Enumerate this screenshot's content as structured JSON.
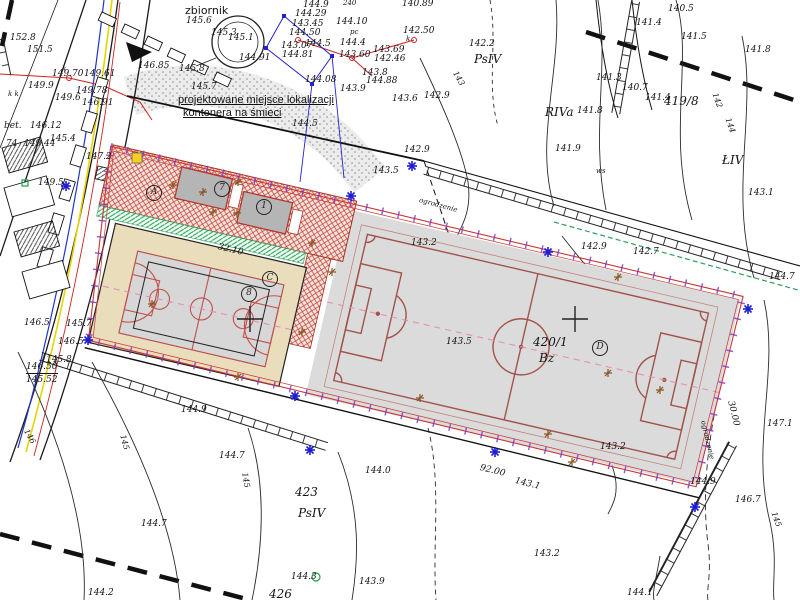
{
  "map": {
    "note_line1": "projektowane miejsce lokalizacji",
    "note_line2": "kontenera na śmieci",
    "parcels_visible": [
      "419/8",
      "420/1",
      "423",
      "426"
    ],
    "land_use_codes": [
      "PsIV",
      "RIVa",
      "ŁIV",
      "Bz",
      "ws"
    ],
    "colors": {
      "fence_red": "#cc3333",
      "tick_purple": "#7d3cc0",
      "hatch_red": "#c0392b",
      "pitch_line_red": "#a2524a",
      "axis_pink": "#e78fb3",
      "green_strip": "#27a35a",
      "field_gray": "#dbdbdb",
      "court_beige": "#e9ddbc",
      "survey_blue": "#1d1dd8",
      "utility_blue": "#2233cc",
      "utility_yellow": "#e8d400",
      "utility_red": "#cc2222",
      "marker_brown": "#8a5420",
      "building_black": "#111111"
    },
    "labels": [
      {
        "t": "152.8",
        "x": 10,
        "y": 34
      },
      {
        "t": "151.5",
        "x": 27,
        "y": 46
      },
      {
        "t": "149.70",
        "x": 52,
        "y": 70
      },
      {
        "t": "149.9",
        "x": 28,
        "y": 82
      },
      {
        "t": "k",
        "x": 62,
        "y": 66,
        "k": "t"
      },
      {
        "t": "k k",
        "x": 8,
        "y": 91,
        "k": "t"
      },
      {
        "t": "149.61",
        "x": 84,
        "y": 70
      },
      {
        "t": "149.78",
        "x": 76,
        "y": 87
      },
      {
        "t": "149.6",
        "x": 55,
        "y": 94
      },
      {
        "t": "146.91",
        "x": 82,
        "y": 99
      },
      {
        "t": "bet.",
        "x": 4,
        "y": 122
      },
      {
        "t": "146.12",
        "x": 30,
        "y": 122
      },
      {
        "t": "74",
        "x": 6,
        "y": 140
      },
      {
        "t": "149.44",
        "x": 24,
        "y": 140
      },
      {
        "t": "145.4",
        "x": 50,
        "y": 135
      },
      {
        "t": "147.2",
        "x": 86,
        "y": 153
      },
      {
        "t": "149.5",
        "x": 38,
        "y": 179
      },
      {
        "t": "146.5",
        "x": 24,
        "y": 319
      },
      {
        "t": "145.7",
        "x": 66,
        "y": 320
      },
      {
        "t": "146.5",
        "x": 58,
        "y": 338
      },
      {
        "t": "145.8",
        "x": 46,
        "y": 356
      },
      {
        "t": "146.50",
        "x": 26,
        "y": 363,
        "k": "fr"
      },
      {
        "t": "145.52",
        "x": 26,
        "y": 376
      },
      {
        "t": "144.9",
        "x": 181,
        "y": 406
      },
      {
        "t": "zbiornik",
        "x": 185,
        "y": 5,
        "k": "n2"
      },
      {
        "t": "145.6",
        "x": 186,
        "y": 17
      },
      {
        "t": "145.1",
        "x": 228,
        "y": 34
      },
      {
        "t": "145.3",
        "x": 211,
        "y": 29
      },
      {
        "t": "144.91",
        "x": 239,
        "y": 54
      },
      {
        "t": "145.8",
        "x": 179,
        "y": 65
      },
      {
        "t": "145.7",
        "x": 191,
        "y": 83
      },
      {
        "t": "146.85",
        "x": 138,
        "y": 62
      },
      {
        "t": "144.9",
        "x": 303,
        "y": 1
      },
      {
        "t": "144.29",
        "x": 295,
        "y": 10
      },
      {
        "t": "143.45",
        "x": 292,
        "y": 20
      },
      {
        "t": "144.50",
        "x": 289,
        "y": 29
      },
      {
        "t": "143.07",
        "x": 281,
        "y": 42
      },
      {
        "t": "144.5",
        "x": 305,
        "y": 40
      },
      {
        "t": "144.81",
        "x": 282,
        "y": 51
      },
      {
        "t": "144.10",
        "x": 336,
        "y": 18
      },
      {
        "t": "144.4",
        "x": 340,
        "y": 39
      },
      {
        "t": "143.69",
        "x": 373,
        "y": 46
      },
      {
        "t": "143.60",
        "x": 339,
        "y": 51
      },
      {
        "t": "142.46",
        "x": 374,
        "y": 55
      },
      {
        "t": "142.50",
        "x": 403,
        "y": 27
      },
      {
        "t": "143.8",
        "x": 362,
        "y": 69
      },
      {
        "t": "144.08",
        "x": 305,
        "y": 76
      },
      {
        "t": "144.88",
        "x": 366,
        "y": 77
      },
      {
        "t": "143.9",
        "x": 340,
        "y": 85
      },
      {
        "t": "240",
        "x": 343,
        "y": 0,
        "k": "t"
      },
      {
        "t": "pc",
        "x": 350,
        "y": 29,
        "k": "t"
      },
      {
        "t": "k",
        "x": 406,
        "y": 36,
        "k": "t"
      },
      {
        "t": "140.89",
        "x": 402,
        "y": 0
      },
      {
        "t": "144.5",
        "x": 292,
        "y": 120
      },
      {
        "t": "143.6",
        "x": 392,
        "y": 95
      },
      {
        "t": "142.9",
        "x": 424,
        "y": 92
      },
      {
        "t": "142.2",
        "x": 469,
        "y": 40
      },
      {
        "t": "PsIV",
        "x": 474,
        "y": 53,
        "k": "lu"
      },
      {
        "t": "142.9",
        "x": 404,
        "y": 146
      },
      {
        "t": "143.5",
        "x": 373,
        "y": 167
      },
      {
        "t": "141.4",
        "x": 636,
        "y": 19
      },
      {
        "t": "140.5",
        "x": 668,
        "y": 5
      },
      {
        "t": "141.5",
        "x": 681,
        "y": 33
      },
      {
        "t": "141.8",
        "x": 745,
        "y": 46
      },
      {
        "t": "141.3",
        "x": 596,
        "y": 74
      },
      {
        "t": "140.7",
        "x": 622,
        "y": 84
      },
      {
        "t": "141.4",
        "x": 645,
        "y": 94
      },
      {
        "t": "419/8",
        "x": 664,
        "y": 95,
        "k": "p"
      },
      {
        "t": "RIVa",
        "x": 545,
        "y": 106,
        "k": "lu"
      },
      {
        "t": "141.8",
        "x": 577,
        "y": 107
      },
      {
        "t": "141.9",
        "x": 555,
        "y": 145
      },
      {
        "t": "ŁIV",
        "x": 722,
        "y": 154,
        "k": "lu"
      },
      {
        "t": "143.1",
        "x": 748,
        "y": 189
      },
      {
        "t": "ws",
        "x": 596,
        "y": 168,
        "k": "t"
      },
      {
        "t": "142",
        "x": 718,
        "y": 92,
        "k": "c",
        "r": 70
      },
      {
        "t": "144",
        "x": 731,
        "y": 117,
        "k": "c",
        "r": 70
      },
      {
        "t": "143",
        "x": 458,
        "y": 70,
        "k": "c",
        "r": 60
      },
      {
        "t": "143.2",
        "x": 411,
        "y": 239
      },
      {
        "t": "143.5",
        "x": 446,
        "y": 338
      },
      {
        "t": "420/1",
        "x": 533,
        "y": 336,
        "k": "p"
      },
      {
        "t": "Bz",
        "x": 539,
        "y": 352,
        "k": "p"
      },
      {
        "t": "142.9",
        "x": 581,
        "y": 243
      },
      {
        "t": "142.7",
        "x": 633,
        "y": 248
      },
      {
        "t": "144.7",
        "x": 769,
        "y": 273
      },
      {
        "t": "143.2",
        "x": 600,
        "y": 443
      },
      {
        "t": "144.9",
        "x": 690,
        "y": 478
      },
      {
        "t": "146.7",
        "x": 735,
        "y": 496
      },
      {
        "t": "147.1",
        "x": 767,
        "y": 420
      },
      {
        "t": "143.2",
        "x": 534,
        "y": 550
      },
      {
        "t": "144.1",
        "x": 627,
        "y": 589
      },
      {
        "t": "145",
        "x": 777,
        "y": 511,
        "k": "c",
        "r": 70
      },
      {
        "t": "30.00",
        "x": 734,
        "y": 400,
        "k": "d",
        "r": 76
      },
      {
        "t": "144.0",
        "x": 365,
        "y": 467
      },
      {
        "t": "423",
        "x": 295,
        "y": 486,
        "k": "p"
      },
      {
        "t": "PsIV",
        "x": 298,
        "y": 507,
        "k": "lu"
      },
      {
        "t": "144.3",
        "x": 291,
        "y": 573
      },
      {
        "t": "143.9",
        "x": 359,
        "y": 578
      },
      {
        "t": "426",
        "x": 269,
        "y": 588,
        "k": "p"
      },
      {
        "t": "92.00",
        "x": 481,
        "y": 464,
        "k": "d",
        "r": 14
      },
      {
        "t": "143.1",
        "x": 516,
        "y": 477,
        "k": "d",
        "r": 14
      },
      {
        "t": "144.7",
        "x": 219,
        "y": 452
      },
      {
        "t": "144.7",
        "x": 141,
        "y": 520
      },
      {
        "t": "144.2",
        "x": 88,
        "y": 589
      },
      {
        "t": "145",
        "x": 248,
        "y": 472,
        "k": "c",
        "r": 80
      },
      {
        "t": "146",
        "x": 29,
        "y": 428,
        "k": "c",
        "r": 60
      },
      {
        "t": "145",
        "x": 126,
        "y": 434,
        "k": "c",
        "r": 75
      },
      {
        "t": "32.10",
        "x": 219,
        "y": 243,
        "k": "d",
        "r": 14
      },
      {
        "t": "ogrodzenie",
        "x": 420,
        "y": 197,
        "k": "t",
        "r": 15
      },
      {
        "t": "ogrodzenie",
        "x": 706,
        "y": 420,
        "k": "t",
        "r": 77
      }
    ],
    "circled": [
      {
        "t": "A",
        "x": 146,
        "y": 185
      },
      {
        "t": "7",
        "x": 214,
        "y": 181
      },
      {
        "t": "1",
        "x": 256,
        "y": 199
      },
      {
        "t": "C",
        "x": 262,
        "y": 271
      },
      {
        "t": "8",
        "x": 241,
        "y": 286
      },
      {
        "t": "D",
        "x": 592,
        "y": 340
      }
    ],
    "markers": {
      "survey-point-icon": [
        [
          351,
          196
        ],
        [
          548,
          252
        ],
        [
          748,
          309
        ],
        [
          695,
          507
        ],
        [
          495,
          452
        ],
        [
          295,
          396
        ],
        [
          88,
          340
        ],
        [
          310,
          450
        ],
        [
          66,
          186
        ],
        [
          412,
          166
        ]
      ],
      "tree-icon": [
        [
          173,
          185
        ],
        [
          203,
          192
        ],
        [
          238,
          182
        ],
        [
          213,
          212
        ],
        [
          237,
          213
        ],
        [
          312,
          243
        ],
        [
          332,
          272
        ],
        [
          618,
          277
        ],
        [
          608,
          373
        ],
        [
          660,
          390
        ],
        [
          572,
          462
        ],
        [
          548,
          434
        ],
        [
          302,
          332
        ],
        [
          238,
          377
        ],
        [
          152,
          304
        ],
        [
          420,
          398
        ]
      ],
      "grid-cross-icon": [
        [
          250,
          319
        ],
        [
          575,
          319
        ]
      ],
      "green-square-icon": [
        [
          25,
          183
        ]
      ],
      "green-circle-icon": [
        [
          316,
          577
        ]
      ],
      "yellow-square-icon": [
        [
          137,
          158
        ]
      ]
    }
  }
}
